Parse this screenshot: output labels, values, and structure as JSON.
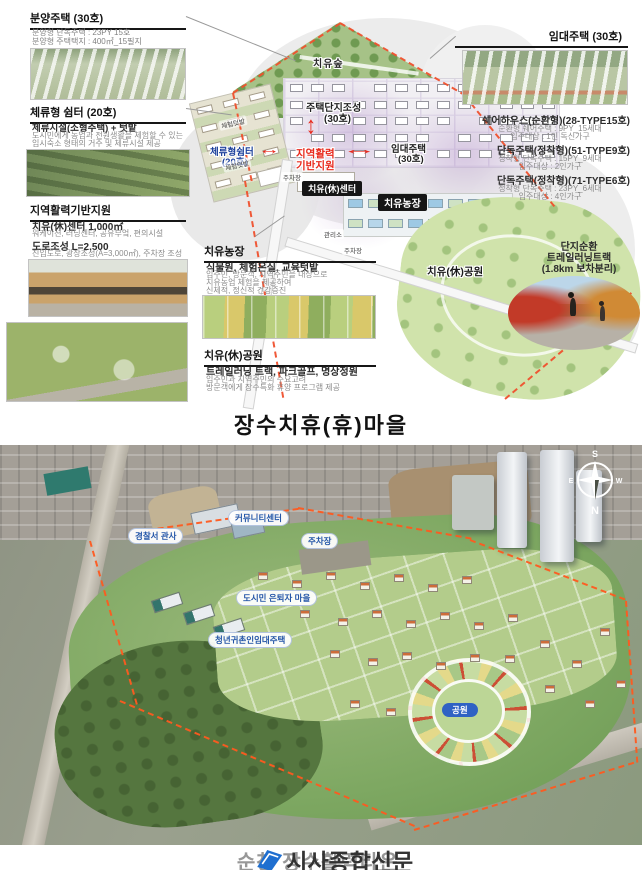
{
  "title": "장수치휴(휴)마을",
  "top": {
    "sale_housing": {
      "title": "분양주택 (30호)",
      "line1": "분양형 단독주택 : 23PY 15호",
      "line2": "분양형 주택택지 : 400㎡_15필지"
    },
    "stay_shelter": {
      "title": "체류형 쉼터 (20호)",
      "subtitle": "체류시설(소형주택) + 텃밭",
      "desc1": "도시민에게 농업과 전원생활을 체험할 수 있는",
      "desc2": "임시숙소 형태의 거주 및 체류시설 제공"
    },
    "regional_support": {
      "title": "지역활력기반지원",
      "item1_title": "치유(休)센터 1,000㎡",
      "item1_desc": "워케이션, 러닝센터, 공유부엌, 편의시설",
      "item2_title": "도로조성 L=2,500",
      "item2_desc": "진입도로, 광장조성(A=3,000㎡), 주차장 조성"
    },
    "healing_farm": {
      "title": "치유농장",
      "subtitle": "식물원, 체험온실, 교육텃밭",
      "desc1": "입주민, 방문객, 지역주민을 대상으로",
      "desc2": "치유농업 체험을 제공하여",
      "desc3": "신체적, 정신적 건강증진"
    },
    "healing_park": {
      "title": "치유(休)공원",
      "subtitle": "트레일러닝 트랙, 파크골프, 명상정원",
      "desc1": "입주민과 지역주민의 수요고려",
      "desc2": "방문객에게 장수특화 휴양 프로그램 제공"
    },
    "rental_housing": {
      "title": "임대주택 (30호)"
    },
    "share_house": {
      "title": "쉐어하우스(순환형)(28-TYPE15호)",
      "desc1": "순환형 쉐어주택 : 9PY_15세대",
      "desc2": "입주대상 : 1인 독신가구"
    },
    "detached_51": {
      "title": "단독주택(정착형)(51-TYPE9호)",
      "desc1": "정착형 단독주택 : 15PY_9세대",
      "desc2": "입주대상 : 2인가구"
    },
    "detached_71": {
      "title": "단독주택(정착형)(71-TYPE6호)",
      "desc1": "정착형 단독주택 : 23PY_6세대",
      "desc2": "입주대상 : 4인가구"
    },
    "trail_track": {
      "line1": "단지순환",
      "line2": "트레일러닝트랙",
      "line3": "(1.8km 보차분리)"
    },
    "map": {
      "forest": "치유숲",
      "housing_line1": "주택단지조성",
      "housing_line2": "(30호)",
      "rental_line1": "임대주택",
      "rental_line2": "(30호)",
      "shelter_line1": "체류형쉼터",
      "shelter_line2": "(20호)",
      "support_line1": "지역활력",
      "support_line2": "기반지원",
      "center_badge": "치유(休)센터",
      "farm_badge": "치유농장",
      "parking1": "주차장",
      "parking2": "주차장",
      "office": "관리소",
      "park_label": "치유(休)공원",
      "plot1": "체험텃밭",
      "plot2": "체험텃밭"
    }
  },
  "icons": {
    "arrow_vertical": "↕",
    "arrow_horizontal": "↔"
  },
  "aerial": {
    "labels": {
      "police": "경찰서 관사",
      "community": "커뮤니티센터",
      "parking": "주차장",
      "retiree": "도시민 은퇴자 마을",
      "youth": "청년귀촌인임대주택",
      "park": "공원"
    },
    "compass": {
      "n": "N",
      "s": "S",
      "e": "E",
      "w": "W"
    }
  },
  "caption": {
    "back": "순창 장수활력타운",
    "front": "시사종합신문"
  },
  "colors": {
    "accent_red": "#e8291c",
    "label_blue": "#1b3f9a",
    "badge_black": "#161616",
    "boundary_orange": "#f0512e"
  }
}
